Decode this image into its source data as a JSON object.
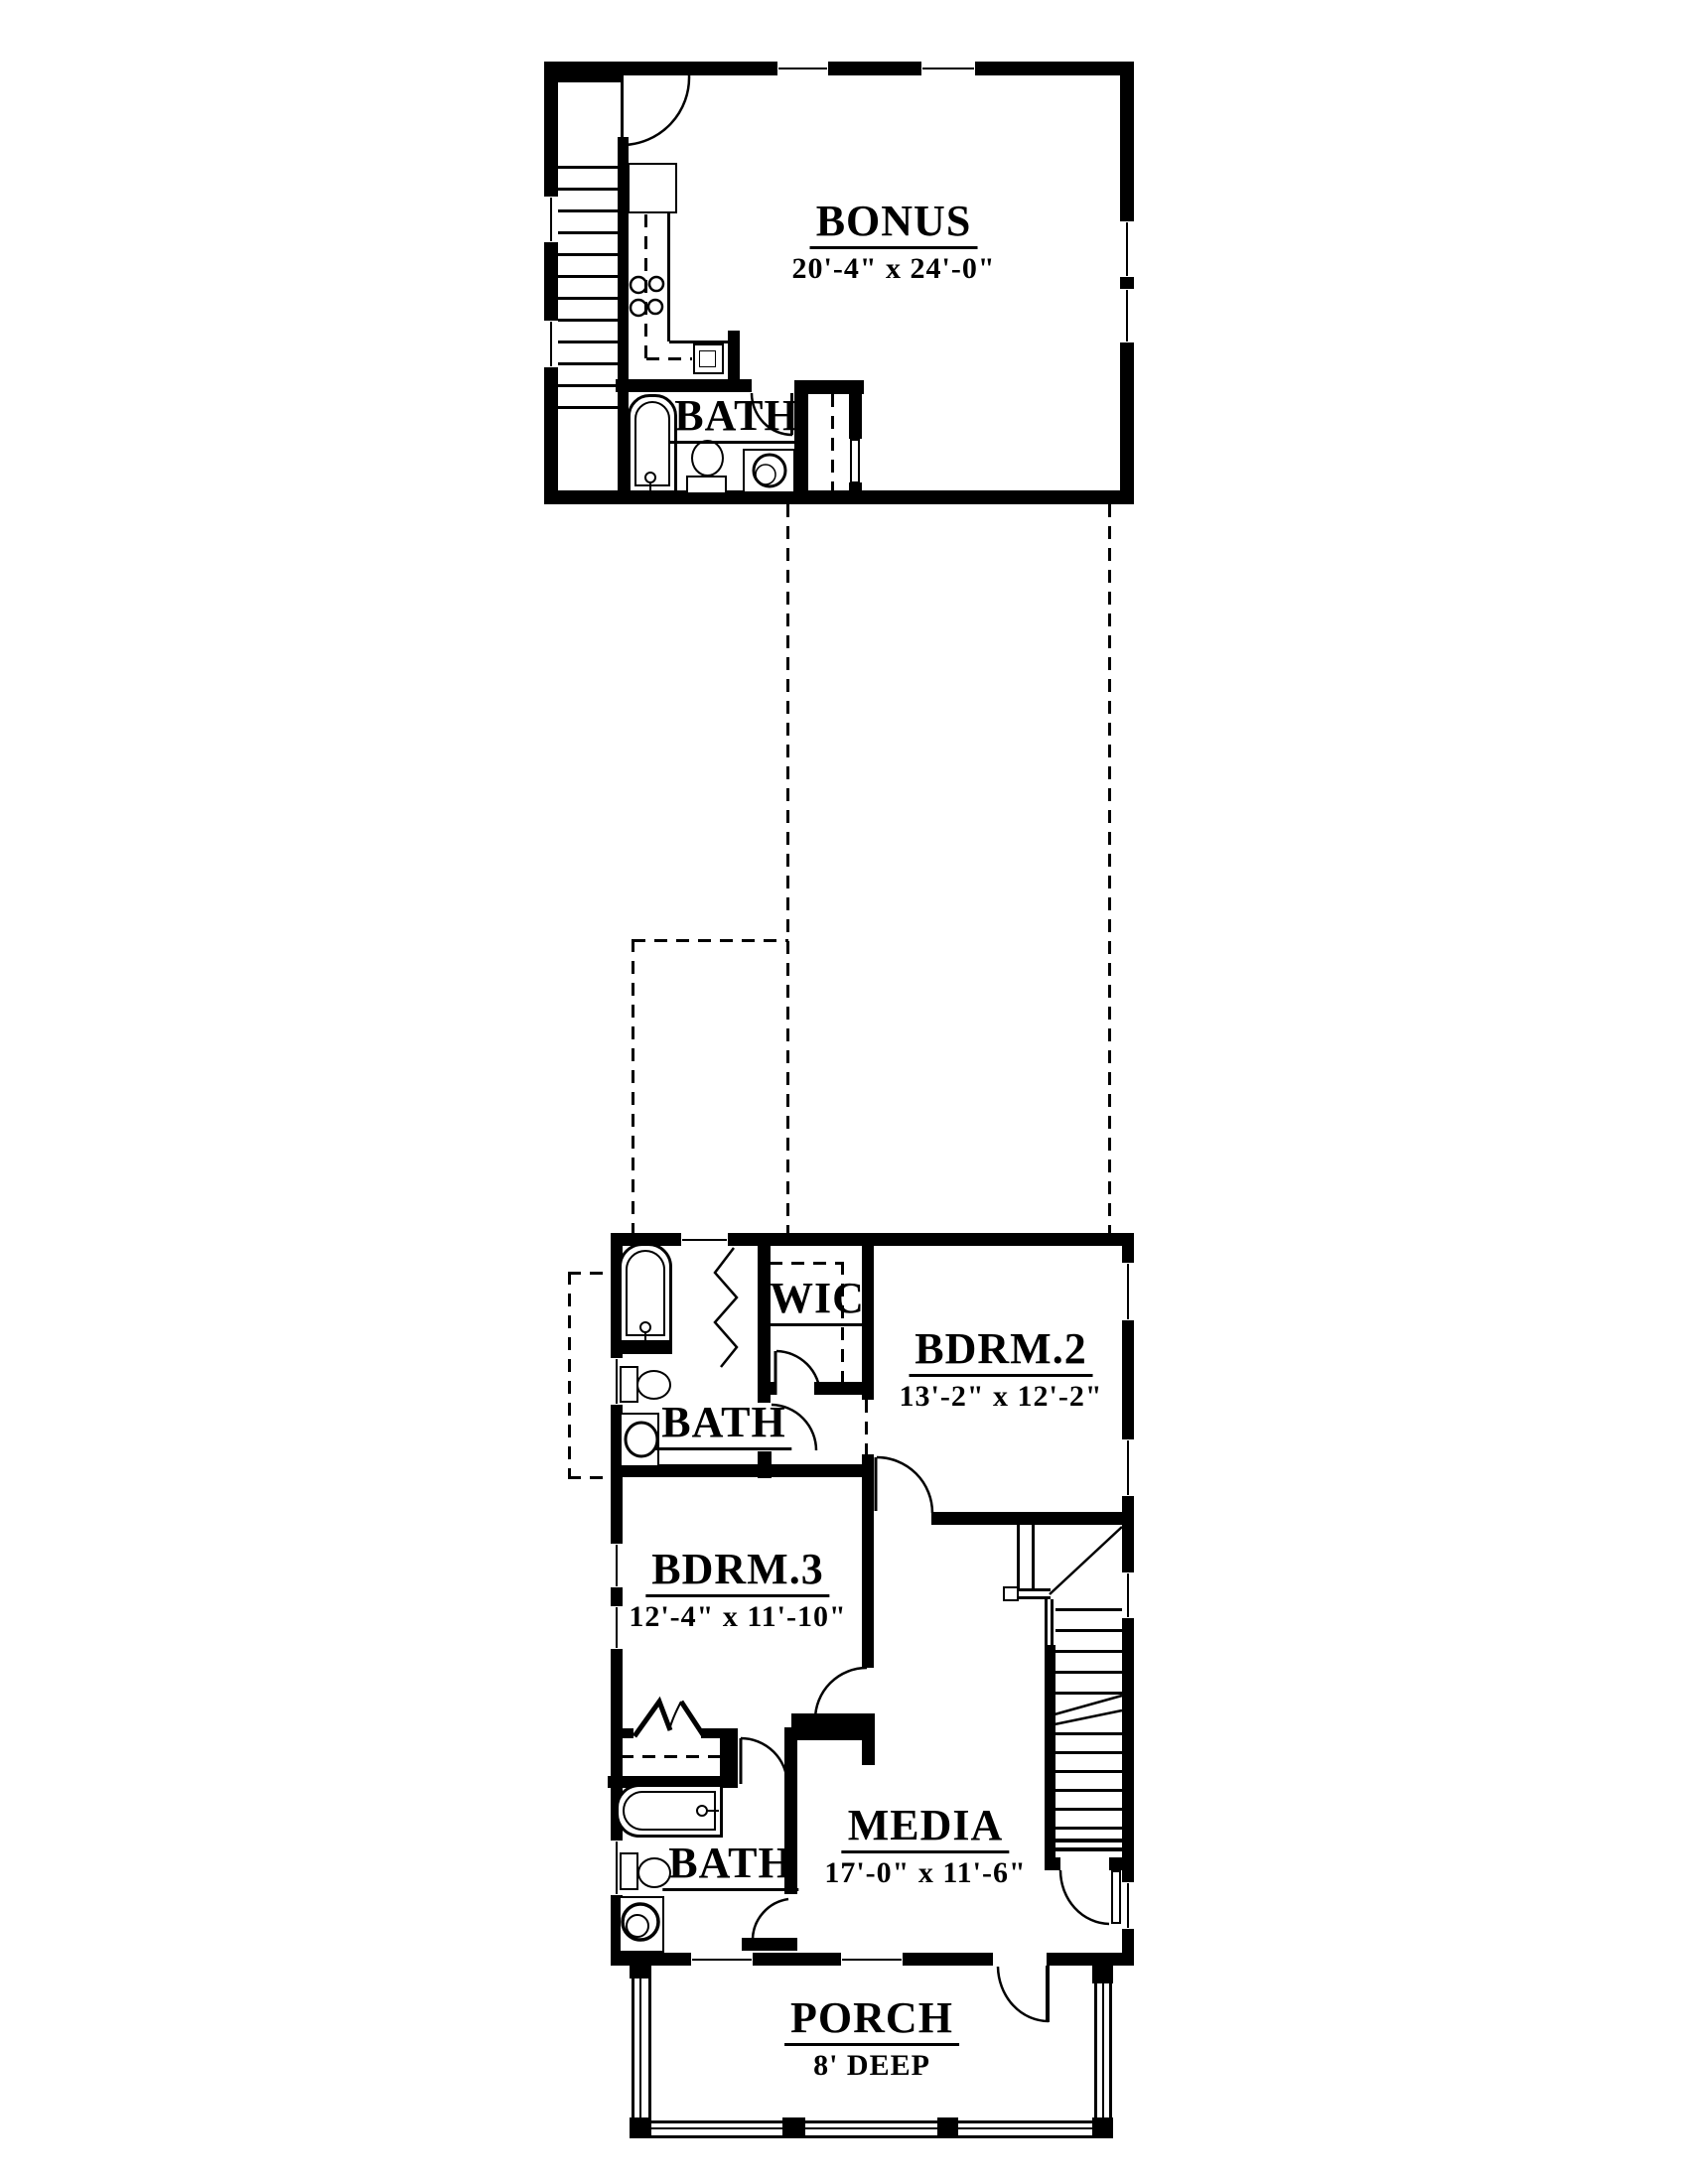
{
  "colors": {
    "line": "#000000",
    "background": "#ffffff"
  },
  "rooms": {
    "bonus": {
      "name": "BONUS",
      "dims": "20'-4\" x 24'-0\""
    },
    "bath_bonus": {
      "name": "BATH"
    },
    "wic": {
      "name": "WIC"
    },
    "bdrm2": {
      "name": "BDRM.2",
      "dims": "13'-2\" x 12'-2\""
    },
    "bath_upper": {
      "name": "BATH"
    },
    "bdrm3": {
      "name": "BDRM.3",
      "dims": "12'-4\" x 11'-10\""
    },
    "media": {
      "name": "MEDIA",
      "dims": "17'-0\" x 11'-6\""
    },
    "bath_lower": {
      "name": "BATH"
    },
    "porch": {
      "name": "PORCH",
      "dims": "8' DEEP"
    }
  }
}
